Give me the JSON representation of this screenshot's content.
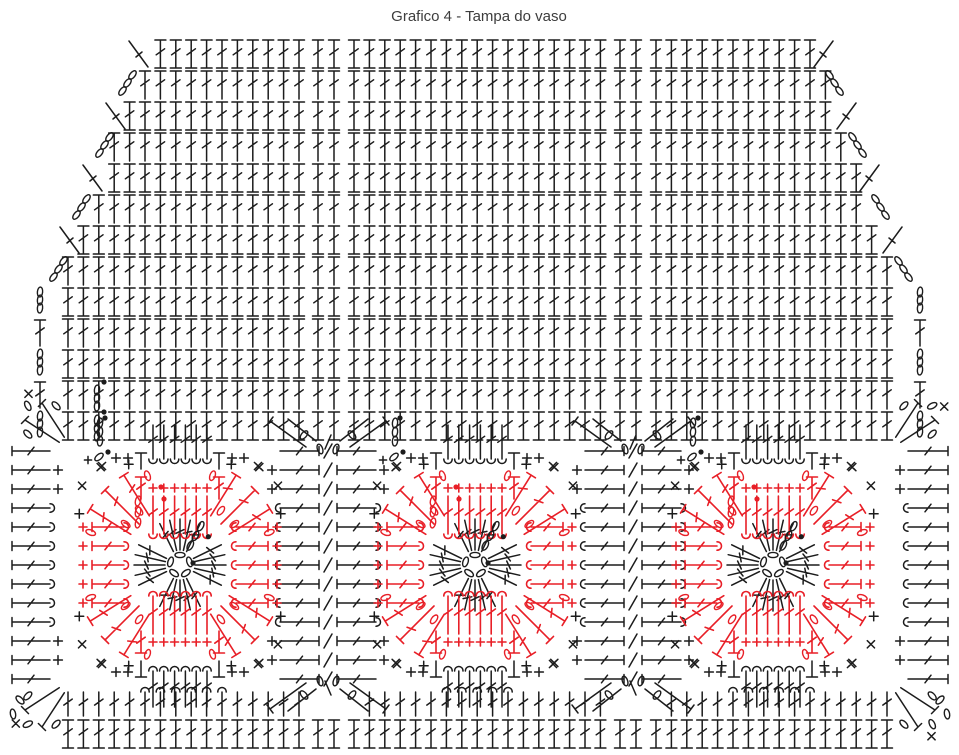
{
  "title": "Grafico 4 - Tampa do vaso",
  "colors": {
    "ink": "#1c1c1c",
    "red": "#e81f27",
    "background": "#ffffff",
    "title_text": "#3d3d3d"
  },
  "canvas": {
    "width": 959,
    "height": 755
  },
  "legend": {
    "chain_stitch": "oval",
    "double_crochet": "t-post-with-tick",
    "single_crochet": "plus",
    "slip_stitch": "filled-dot",
    "crossed_stitch": "x-mark",
    "post_stitch": "hook-curl",
    "magic_ring": "circle-of-chain-ovals"
  },
  "diagram": {
    "grid": {
      "rows": 13,
      "y0": 40,
      "row_step": 31,
      "stem": 28,
      "col_segments": [
        [
          68,
          299,
          15.4
        ],
        [
          318,
          334,
          16
        ],
        [
          354,
          601,
          15.4
        ],
        [
          620,
          636,
          16
        ],
        [
          656,
          888,
          15.4
        ]
      ],
      "top_left_x": 150,
      "top_right_x": 812,
      "slope_per_row": 11.5,
      "left_min_x": 65,
      "right_max_x": 896,
      "diag_rows": 8,
      "edge_chain_x": [
        40,
        920
      ],
      "start_marker": {
        "x": 97,
        "ys": [
          386,
          416
        ]
      }
    },
    "motifs": {
      "cy": 565,
      "centers": [
        180,
        475,
        773
      ],
      "ring_radius": 10,
      "ring_chains": 5,
      "inner_groups": [
        -90,
        0,
        90,
        180
      ],
      "inner_offsets": [
        -26,
        -13,
        0,
        13,
        26
      ],
      "inner_r": [
        15,
        46
      ],
      "fan_angles": [
        -45,
        -135,
        45,
        135
      ],
      "fan_offsets": [
        -13,
        0,
        13
      ],
      "fan_r": [
        58,
        106
      ],
      "side_rows": [
        -2,
        -1,
        0,
        1,
        2
      ],
      "side_row_step": 19,
      "petal_stems": 6,
      "petal_step": 10.8
    },
    "seams": {
      "x": [
        328,
        633
      ],
      "row_step": 19,
      "half_rows": 6,
      "left_bar_x": 12,
      "right_bar_x": 948
    },
    "bottom": {
      "row_a_y": 692,
      "row_a_stem": 24,
      "row_b_y": 720,
      "row_b_stem": 28,
      "x_min": 40,
      "x_max": 920
    },
    "corner_fans": [
      [
        66,
        444,
        -1,
        -1
      ],
      [
        894,
        444,
        1,
        -1
      ],
      [
        66,
        686,
        -1,
        1
      ],
      [
        894,
        686,
        1,
        1
      ]
    ]
  }
}
